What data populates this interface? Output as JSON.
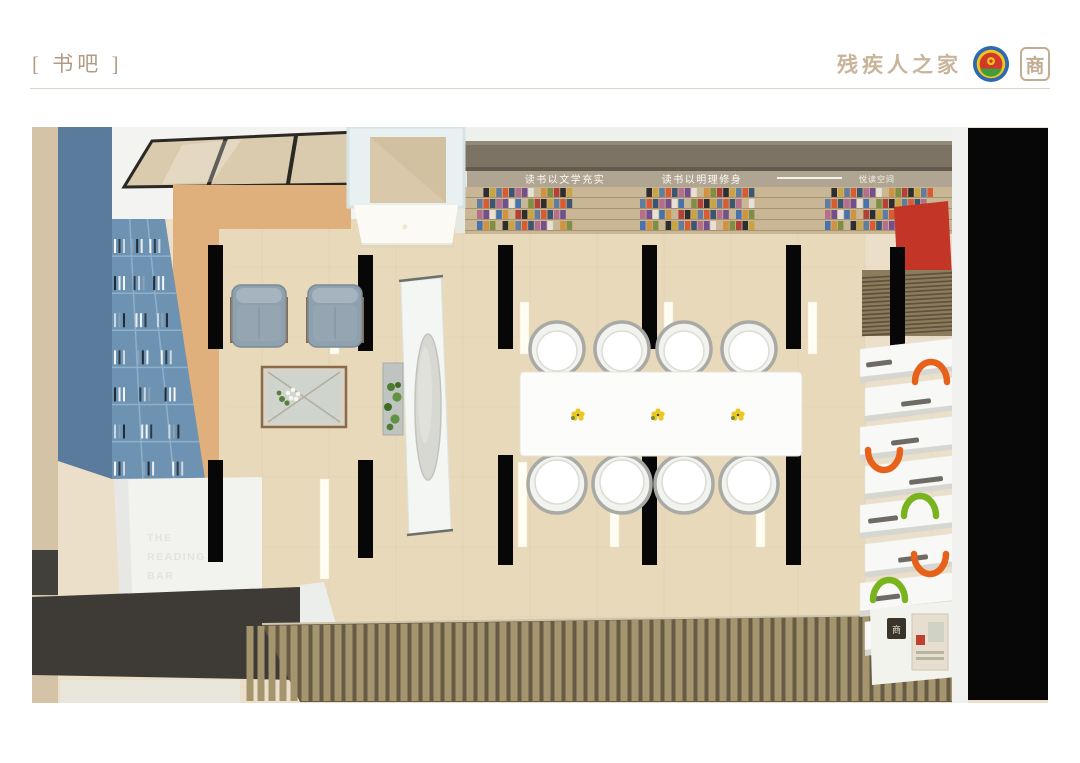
{
  "header": {
    "title": "[ 书吧 ]",
    "brand_text": "残疾人之家",
    "brand_seal": "商"
  },
  "render": {
    "shelf_slogan_left": "读书以文学充实",
    "shelf_slogan_right": "读书以明理修身",
    "shelf_slogan_small": "悦读空间",
    "wall_text": [
      "THE",
      "READING",
      "BAR"
    ],
    "seal_small": "商",
    "colors": {
      "floor": "#ebdfc9",
      "carpet": "#e7d9ba",
      "orange_wall": "#e0b07c",
      "bookshelf_blue_face": "#5b7b9d",
      "bookshelf_blue_cells": "#6e92b2",
      "panel_red": "#c23527",
      "arc_orange": "#e8611a",
      "arc_green": "#79b41e",
      "wood_slat": "#a5956f",
      "black_band": "#070707"
    },
    "book_palette": [
      "#b23b33",
      "#35506e",
      "#d2903c",
      "#5b79a0",
      "#e8e3d8",
      "#26262a",
      "#b46a8a",
      "#7a8c3e",
      "#d9572b",
      "#3f6fae",
      "#caa23d",
      "#704a8c"
    ],
    "spine_palette": [
      "#f4f6f8",
      "#2c3c4a",
      "#cdd8e0",
      "#88a3bb",
      "#1e2c39",
      "#e8eef2"
    ]
  }
}
